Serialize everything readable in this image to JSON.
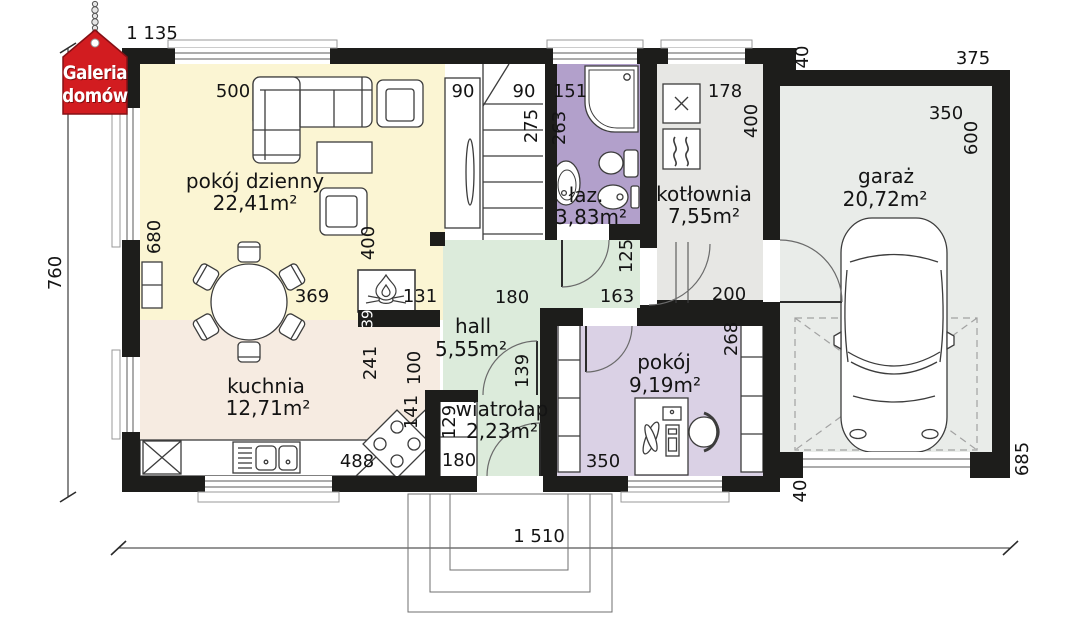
{
  "logo": {
    "line1": "Galeria",
    "line2": "domów"
  },
  "colors": {
    "wall": "#1d1d1b",
    "logo_red": "#d21c20",
    "living_floor": "#fbf5d3",
    "kitchen_floor": "#f6ebe1",
    "hall_floor": "#dcebdb",
    "vestibule_floor": "#dcebdb",
    "bathroom_floor": "#b2a0cb",
    "boiler_floor": "#e7e7e4",
    "bedroom_floor": "#dad1e5",
    "garage_floor": "#e9ece9",
    "stairs_floor": "#ffffff"
  },
  "rooms": {
    "living": {
      "name": "pokój dzienny",
      "area": "22,41m²"
    },
    "kitchen": {
      "name": "kuchnia",
      "area": "12,71m²"
    },
    "hall": {
      "name": "hall",
      "area": "5,55m²"
    },
    "vestibule": {
      "name": "wiatrołap",
      "area": "2,23m²"
    },
    "bathroom": {
      "name": "łaz.",
      "area": "3,83m²"
    },
    "boiler_room": {
      "name": "kotłownia",
      "area": "7,55m²"
    },
    "bedroom": {
      "name": "pokój",
      "area": "9,19m²"
    },
    "garage": {
      "name": "garaż",
      "area": "20,72m²"
    }
  },
  "dimensions": {
    "top_left_width": "1 135",
    "sofa_wall": "500",
    "closet_width": "90",
    "stairs_width": "90",
    "stairs_depth": "275",
    "bath_width": "151",
    "bath_height": "263",
    "boiler_width": "178",
    "boiler_height": "400",
    "garage_wall_top": "40",
    "garage_top_width": "375",
    "garage_inner_width": "350",
    "garage_inner_height": "600",
    "left_total_height": "760",
    "living_left": "680",
    "living_right": "400",
    "table": "369",
    "fireplace": "131",
    "fireplace_wall": "39",
    "hall_opening": "180",
    "hall_width": "163",
    "hall_right": "125",
    "boiler_passage": "200",
    "hall_door": "139",
    "kitchen_height": "241",
    "kitchen_passage": "100",
    "hob": "141",
    "counter": "488",
    "vest_closet_depth": "129",
    "vest_closet_width": "180",
    "bedroom_width": "350",
    "bedroom_height": "268",
    "bottom_total_width": "1 510",
    "garage_wall_bottom": "40",
    "garage_right_height": "685"
  },
  "symbols": {
    "fireplace": "flame",
    "washer": "x-cross",
    "boiler": "heat-waves",
    "fridge": "x-box"
  }
}
